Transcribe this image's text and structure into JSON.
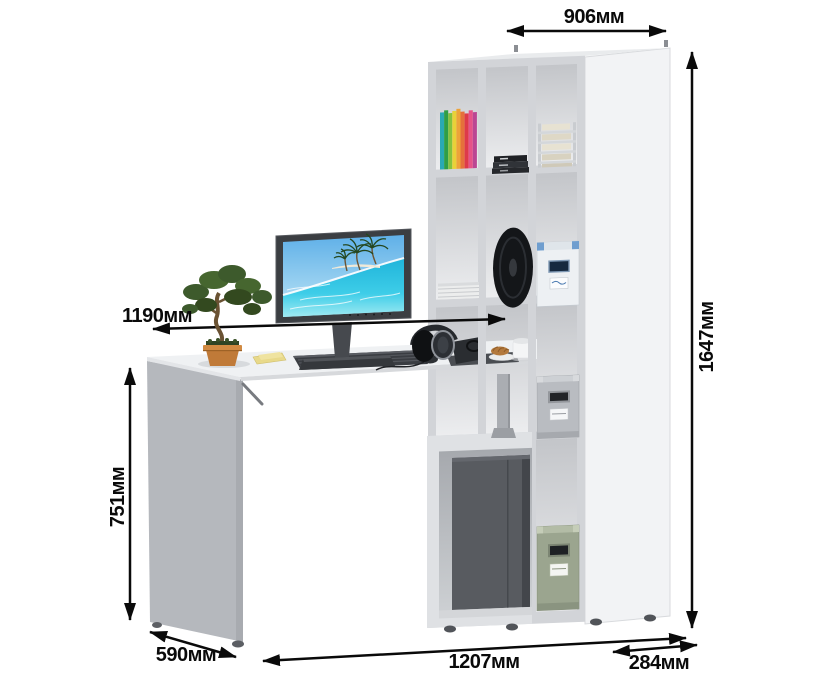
{
  "diagram": {
    "type": "furniture-dimension-diagram",
    "subject": "corner computer desk with open shelving bookcase",
    "unit_suffix": "мм"
  },
  "dimensions": {
    "top_width": "906мм",
    "total_height": "1647мм",
    "desktop_width": "1190мм",
    "desk_height": "751мм",
    "desk_depth": "590мм",
    "total_width": "1207мм",
    "bookcase_depth": "284мм"
  },
  "colors": {
    "background": "#ffffff",
    "dimension_lines": "#0a0a0a",
    "bookcase_frame": "#d3d5d8",
    "bookcase_side": "#f2f3f5",
    "desk_side_panel": "#b5b8bd",
    "desk_top": "#eff1f3",
    "pc_tower": "#585b60",
    "storage_box_gray": "#b9bcc1",
    "storage_box_green": "#9ba58f",
    "storage_box_blue_trim": "#6f9ecf",
    "screen_sea": "#2cc0e2",
    "screen_sky": "#6db4ea",
    "bonsai_foliage": "#43602e",
    "bonsai_pot": "#c07a38",
    "book_spine_colors": [
      "#2aa9b4",
      "#2f9e47",
      "#86c23e",
      "#e9d138",
      "#eda339",
      "#e5703b",
      "#de3a4a",
      "#e65288",
      "#bb4693"
    ]
  },
  "scene_objects": [
    "shelving-unit",
    "computer-desk",
    "lcd-monitor",
    "keyboard",
    "headphones",
    "coffee-cup",
    "croissant-plate",
    "bonsai-tree",
    "sticky-notes",
    "rainbow-books",
    "black-books",
    "paper-tray",
    "magazine-stack",
    "speaker-disc",
    "storage-box-white-blue",
    "storage-box-gray",
    "storage-box-green",
    "pc-tower",
    "support-post"
  ]
}
